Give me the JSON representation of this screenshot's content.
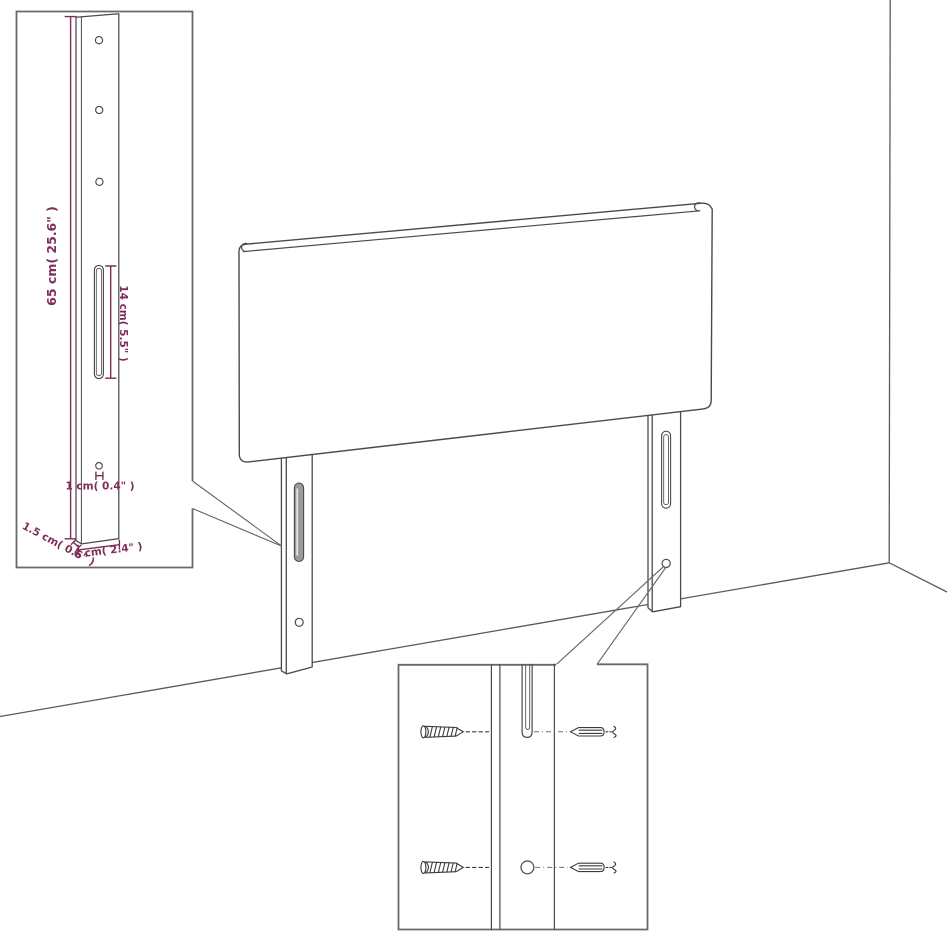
{
  "colors": {
    "background": "#ffffff",
    "artwork_line": "#4a4a4a",
    "wall_line": "#5a5a5a",
    "inset_border": "#6a6a6a",
    "pointer_line": "#646464",
    "dimension": "#7e2d58",
    "slot_fill": "#9b9b9b"
  },
  "leg_detail_inset": {
    "dimensions": {
      "height": "65 cm( 25.6\" )",
      "slot_length": "14 cm( 5.5\" )",
      "hole_diameter": "1 cm( 0.4\" )",
      "thickness": "1.5 cm( 0.6\" )",
      "width": "6 cm( 2.4\" )"
    }
  }
}
